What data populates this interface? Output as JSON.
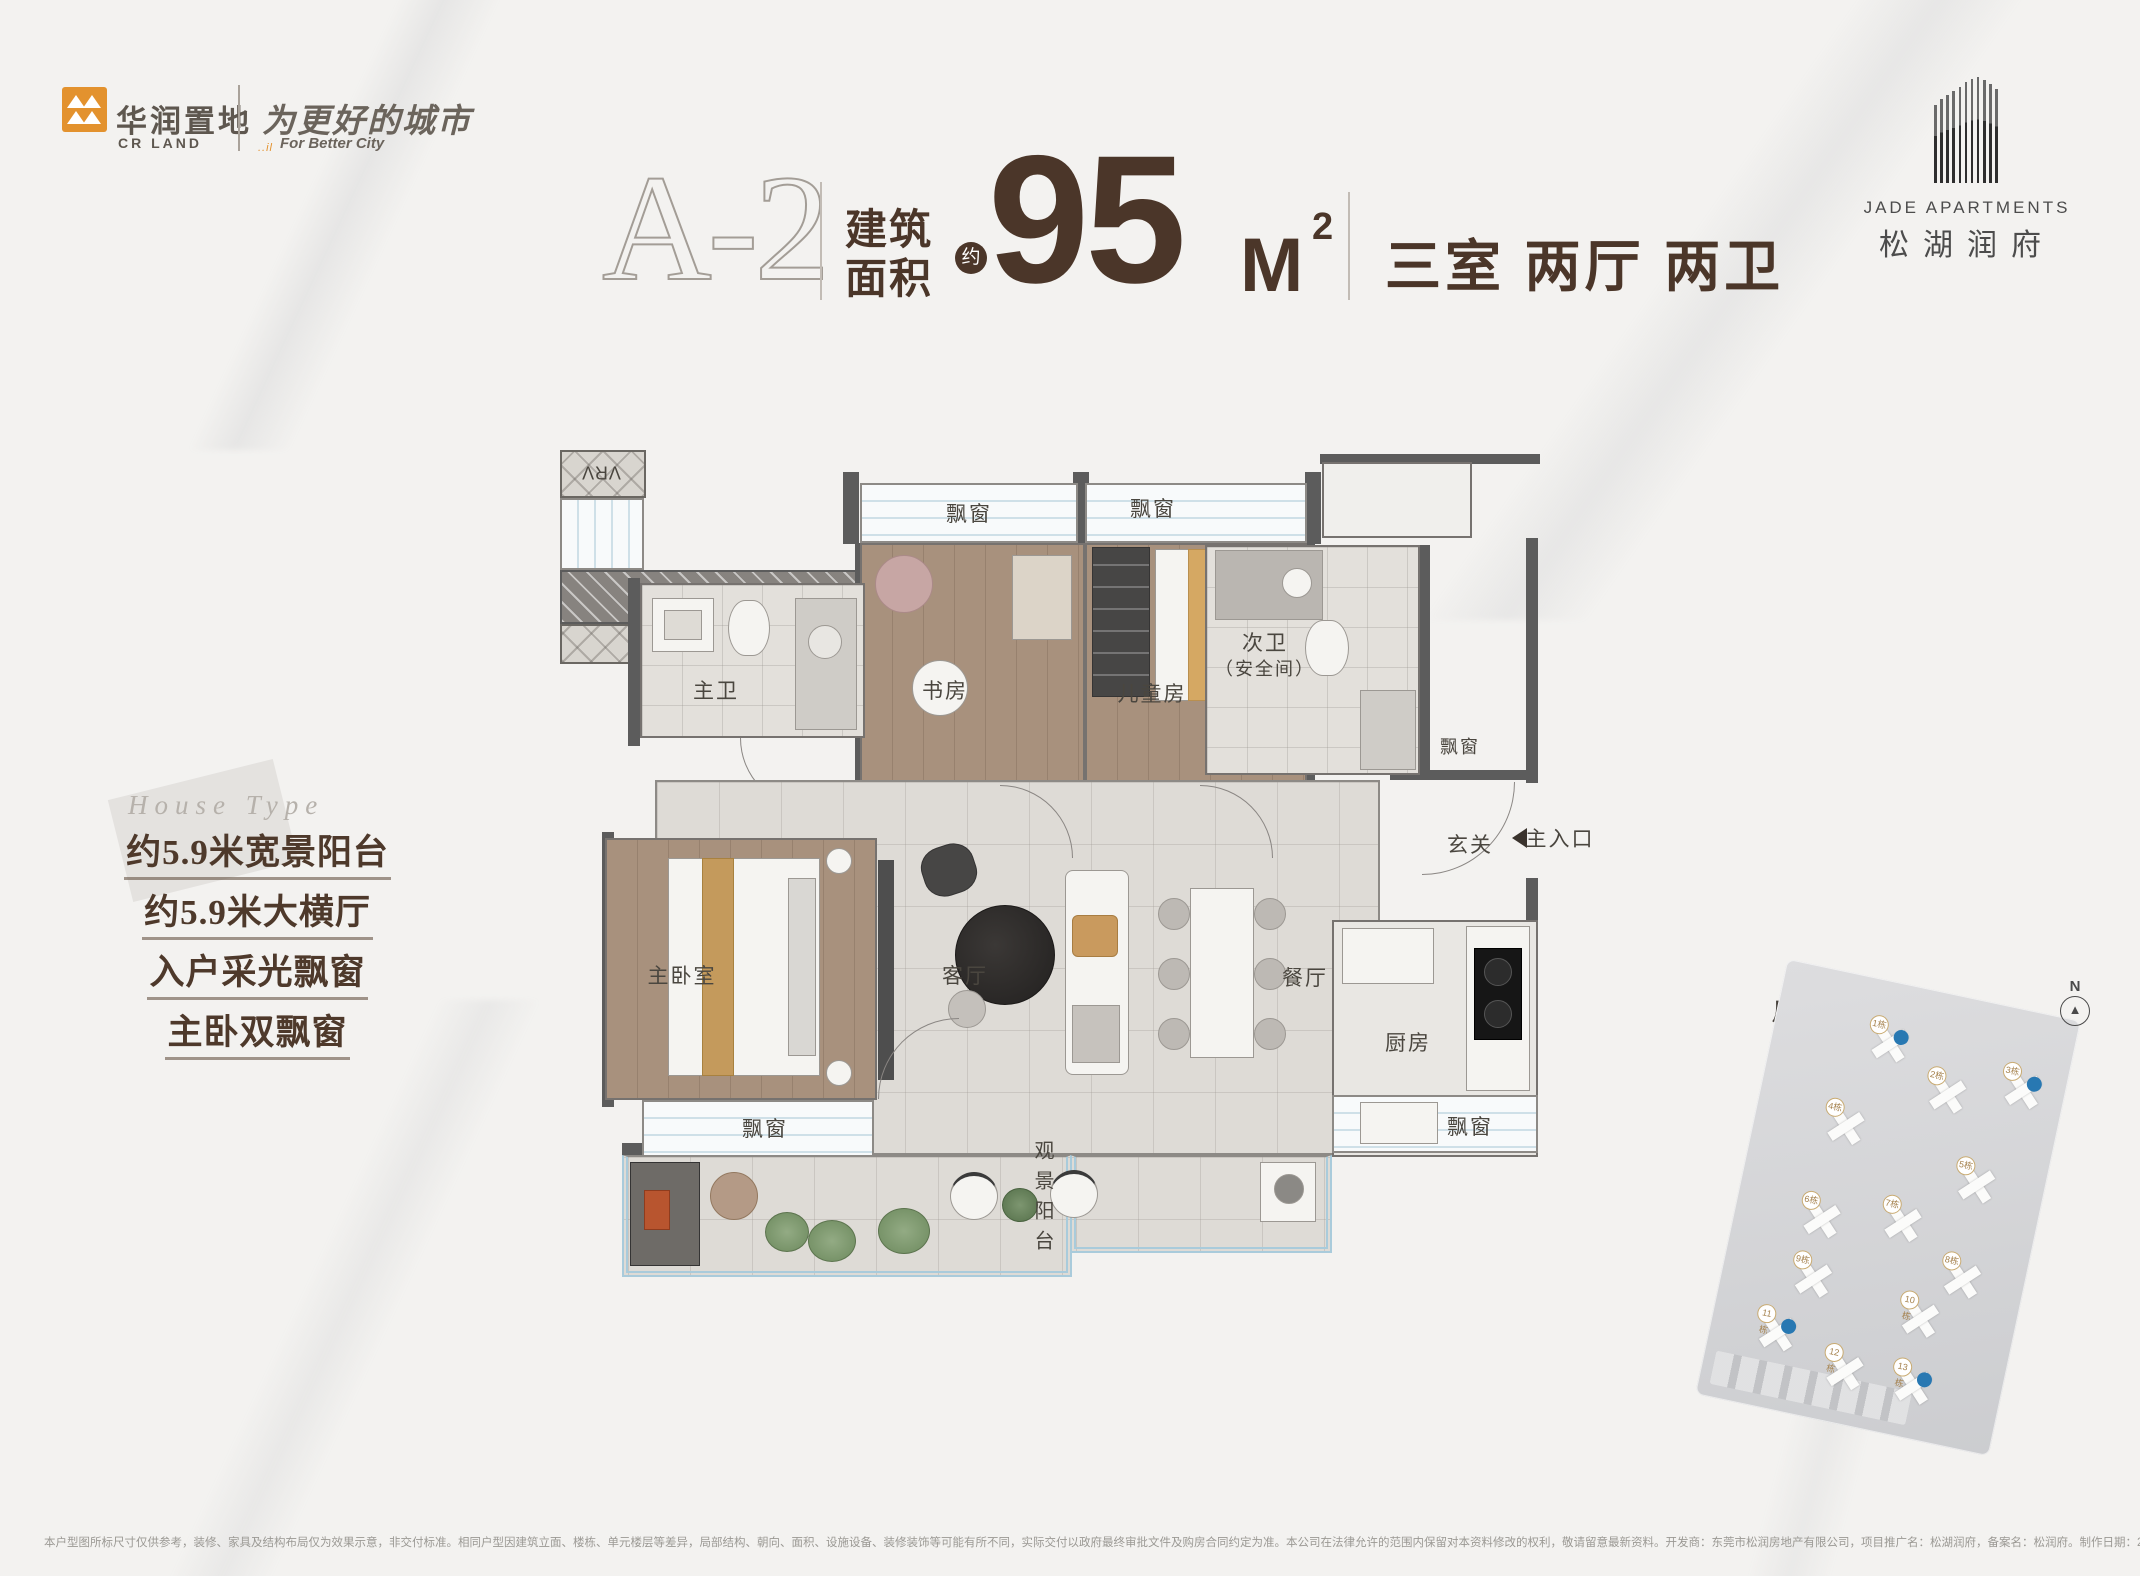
{
  "header": {
    "brand": {
      "cn": "华润置地",
      "en": "CR LAND",
      "slogan_cn": "为更好的城市",
      "slogan_en": "For Better City",
      "slogan_ticks": "..il"
    },
    "unit": {
      "type_label": "A-2",
      "area_prefix_line1": "建筑",
      "area_prefix_line2": "面积",
      "approx": "约",
      "area_value": "95",
      "area_unit": "M",
      "area_sup": "2",
      "layout": "三室 两厅 两卫"
    },
    "project": {
      "en": "JADE APARTMENTS",
      "cn": "松湖润府"
    }
  },
  "selling_points": {
    "script": "House Type",
    "items": [
      "约5.9米宽景阳台",
      "约5.9米大横厅",
      "入户采光飘窗",
      "主卧双飘窗"
    ]
  },
  "floor_plan": {
    "rooms": {
      "bay_window": "飘窗",
      "study": "书房",
      "kids_room": "儿童房",
      "second_bath_l1": "次卫",
      "second_bath_l2": "（安全间）",
      "master_bath": "主卫",
      "master_bedroom": "主卧室",
      "living_room": "客厅",
      "dining_room": "餐厅",
      "kitchen": "厨房",
      "entry": "玄关",
      "balcony": "观景阳台",
      "vrv": "VRV",
      "main_entrance": "主入口"
    }
  },
  "site_map": {
    "label": "户型落位图",
    "north": "N",
    "north_glyph": "▲",
    "buildings": [
      {
        "label": "1栋",
        "x": 118,
        "y": 62,
        "hl": true
      },
      {
        "label": "2栋",
        "x": 185,
        "y": 100,
        "hl": false
      },
      {
        "label": "3栋",
        "x": 258,
        "y": 80,
        "hl": true
      },
      {
        "label": "4栋",
        "x": 92,
        "y": 152,
        "hl": false
      },
      {
        "label": "5栋",
        "x": 232,
        "y": 182,
        "hl": false
      },
      {
        "label": "6栋",
        "x": 88,
        "y": 248,
        "hl": false
      },
      {
        "label": "7栋",
        "x": 168,
        "y": 235,
        "hl": false
      },
      {
        "label": "8栋",
        "x": 238,
        "y": 278,
        "hl": false
      },
      {
        "label": "9栋",
        "x": 92,
        "y": 308,
        "hl": false
      },
      {
        "label": "10栋",
        "x": 205,
        "y": 325,
        "hl": false
      },
      {
        "label": "11栋",
        "x": 68,
        "y": 368,
        "hl": true
      },
      {
        "label": "12栋",
        "x": 142,
        "y": 392,
        "hl": false
      },
      {
        "label": "13栋",
        "x": 212,
        "y": 392,
        "hl": true
      }
    ]
  },
  "disclaimer": "本户型图所标尺寸仅供参考，装修、家具及结构布局仅为效果示意，非交付标准。相同户型因建筑立面、楼栋、单元楼层等差异，局部结构、朝向、面积、设施设备、装修装饰等可能有所不同，实际交付以政府最终审批文件及购房合同约定为准。本公司在法律允许的范围内保留对本资料修改的权利，敬请留意最新资料。开发商：东莞市松润房地产有限公司，项目推广名：松湖润府，备案名：松润府。制作日期：2023年7月，有效期：6个月。"
}
